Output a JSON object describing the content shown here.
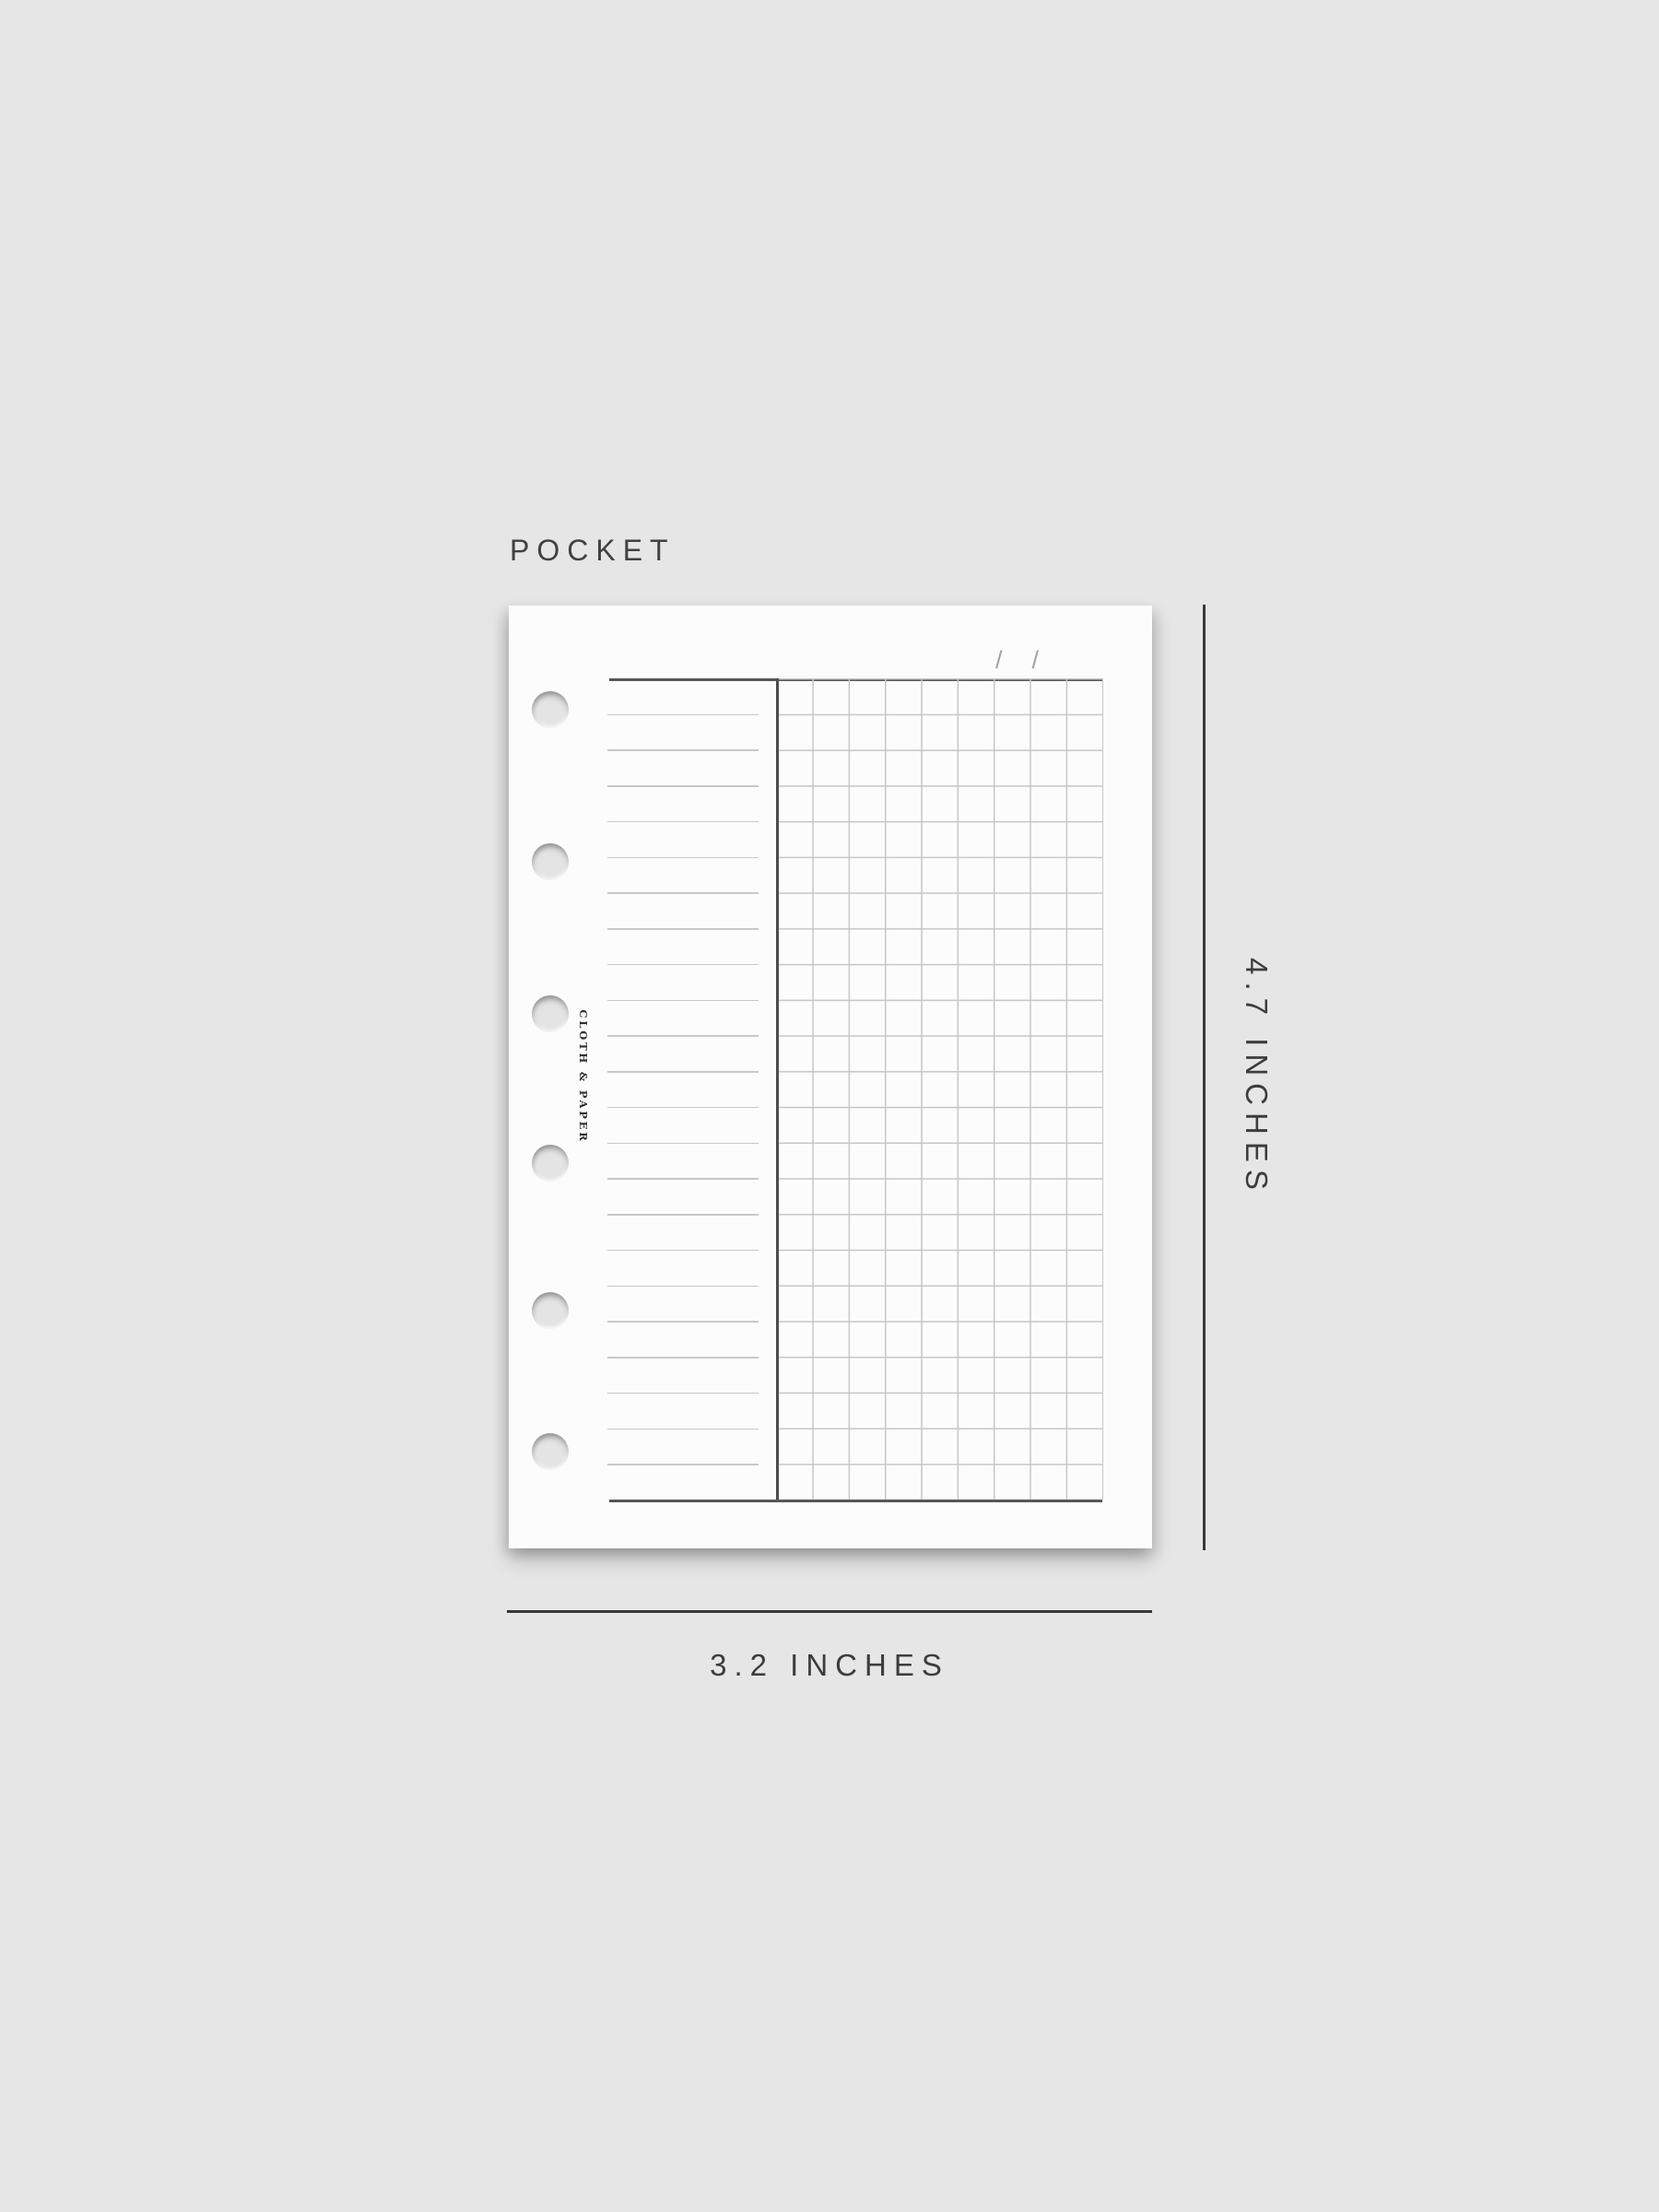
{
  "page": {
    "size_label": "POCKET",
    "brand": "CLOTH & PAPER",
    "date_slashes": [
      "/",
      "/"
    ],
    "height_label": "4.7 INCHES",
    "width_label": "3.2 INCHES"
  },
  "insert": {
    "ruled_lines": 22,
    "grid_columns": 9,
    "grid_rows": 23,
    "holes": 6
  },
  "colors": {
    "background": "#e6e6e6",
    "card": "#fcfcfc",
    "rule_dark": "#57575a",
    "line_light": "#c8c8ca",
    "dimension": "#39393b",
    "slash": "#a2a2a4"
  }
}
